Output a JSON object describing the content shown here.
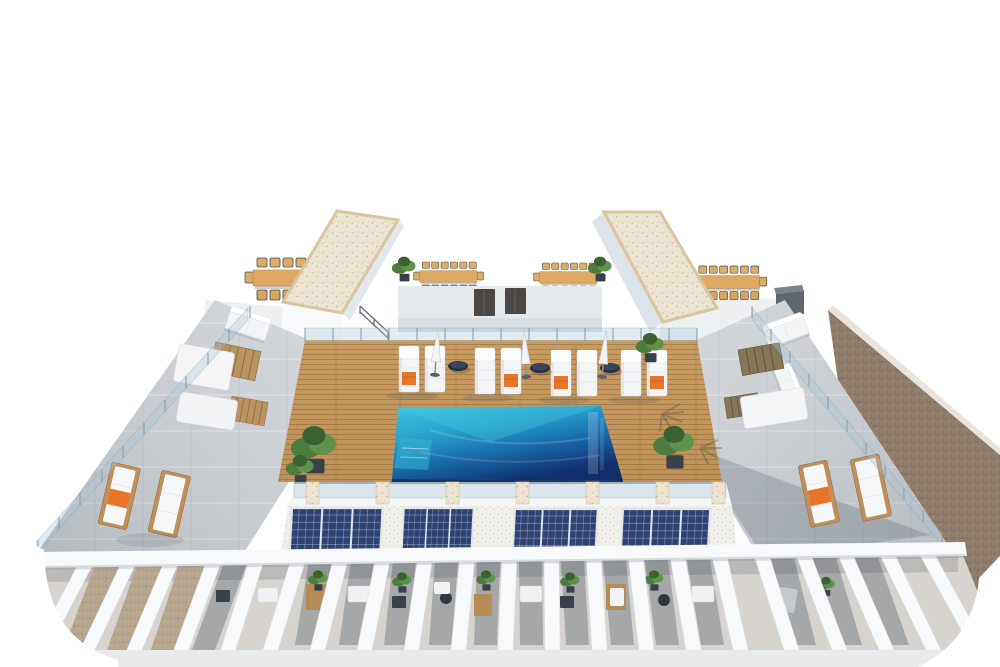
{
  "scene": {
    "domain": "natural-image",
    "description": "Aerial 3D architectural rendering of a residential rooftop terrace: central turquoise swimming pool on a wooden sun deck with white sun loungers, orange towels, closed parasols and navy side tables; two white stairwell towers with beige gravel roofs; communal wooden dining tables with chairs; concrete side terraces with daybeds, sofas and wooden loungers; four solar-panel arrays on the lower white gravel roof; a row of white pergola fins over private terraces; brown gravel neighbouring roof on the right; white background.",
    "inventory": {
      "swimming_pool": 1,
      "deck_sun_loungers": 8,
      "orange_towels": 4,
      "closed_umbrellas": 3,
      "round_side_tables": 3,
      "dining_tables": 4,
      "stairwell_towers": 2,
      "access_doors": 2,
      "side_terrace_wood_loungers": 4,
      "daybeds_and_sofas": 6,
      "slat_mats": 4,
      "solar_panel_banks": 4,
      "solar_panels_per_bank": 3,
      "pergola_fins": 21,
      "pergola_terraces": 12,
      "potted_plants": 10
    }
  },
  "colors": {
    "background": "#ffffff",
    "tower_roof": "#ece4d3",
    "tower_roof_edge": "#d8c69e",
    "tower_white": "#f8f9fa",
    "tower_shade": "#e2e7eb",
    "upper_wall": "#e7eaec",
    "upper_floor": "#edeff1",
    "door_dark": "#4b4744",
    "wood_table": "#dfa963",
    "chair_wood": "#dcab66",
    "deck_wood": "#c89b60",
    "pool_shallow": "#3dc7de",
    "pool_mid": "#1c77b4",
    "pool_deep": "#102f6b",
    "pool_edge_dark": "#14305e",
    "lounger_white": "#f3f5f6",
    "towel_orange": "#e8762a",
    "side_table_navy": "#273043",
    "terrace_concrete": "#cdd1d5",
    "sofa_white": "#f3f4f5",
    "wood_lounger_frame": "#c0905a",
    "slat_mat_wood": "#b99361",
    "solar_panel_blue": "#2d4373",
    "white_gravel": "#f0efe9",
    "brown_gravel": "#8f7d6b",
    "tan_gravel": "#b7a78e",
    "pergola_floor": "#d7d4cf",
    "plant_green": "#4d7c3e",
    "planter_dark": "#384049",
    "walkway_gray": "#e9eaec",
    "dark_box_gray": "#5f666e"
  }
}
